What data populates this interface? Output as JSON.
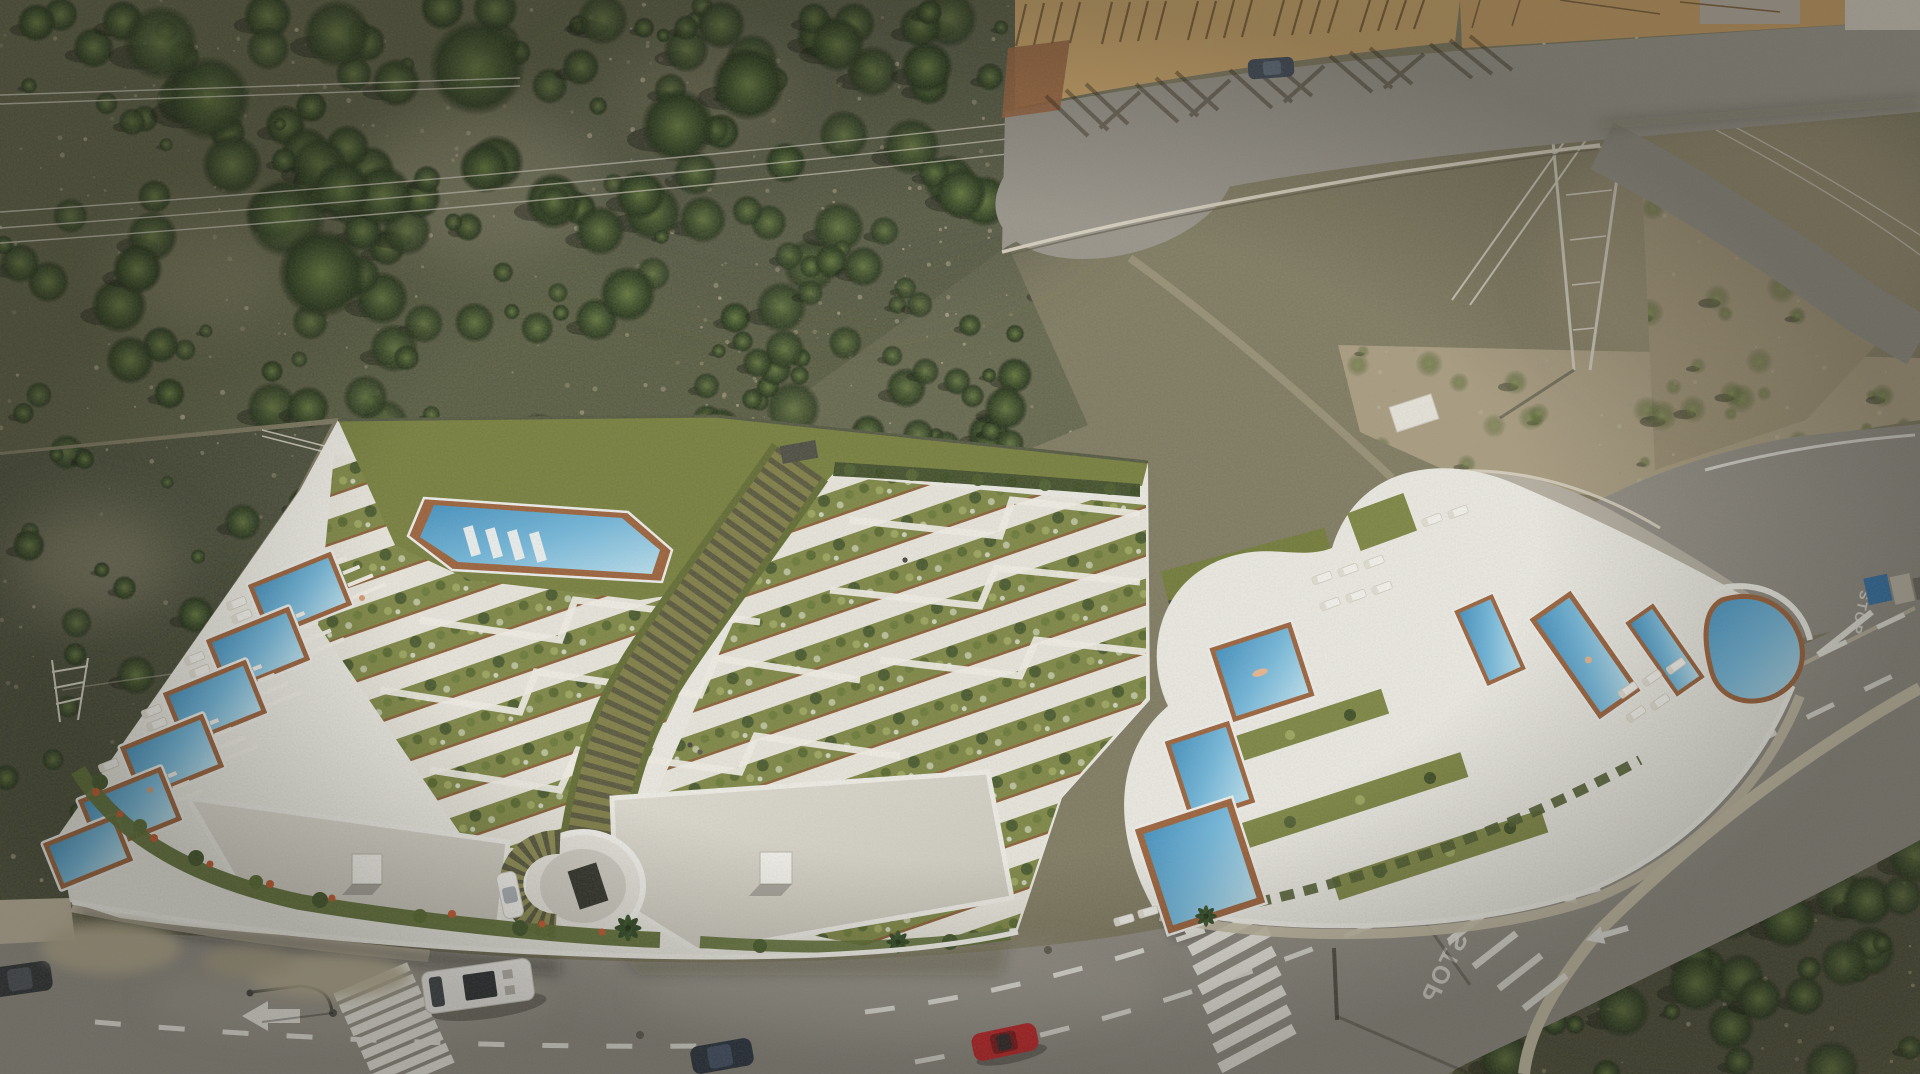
{
  "meta": {
    "title": "Aerial drone view of a terraced apartment development with pools on a Mediterranean scrubland hillside"
  },
  "scene": {
    "setting": "Hillside scrubland, new white terraced apartment complex with private pools, communal pool, central stepped walkway, access roads, construction site and power pylon",
    "road_markings": {
      "stop_label": "STOP"
    },
    "palette": {
      "asphalt": "#908c84",
      "asphalt2": "#97938a",
      "terrace_white": "#ecebe4",
      "lawn_green": "#747d3a",
      "garden_green": "#7b8542",
      "gravel": "#b5afa2",
      "deck_wood": "#9a5f38",
      "roof_gray": "#d9d6cc",
      "pool_blue": "#5fa9d4",
      "scrub_dark": "#565a40",
      "scrub_light": "#a79b7f"
    },
    "counts": {
      "communal_pools": 1,
      "private_pools_left": 6,
      "right_wing_pools": 6,
      "vehicles": 8,
      "crosswalks": 2
    }
  }
}
